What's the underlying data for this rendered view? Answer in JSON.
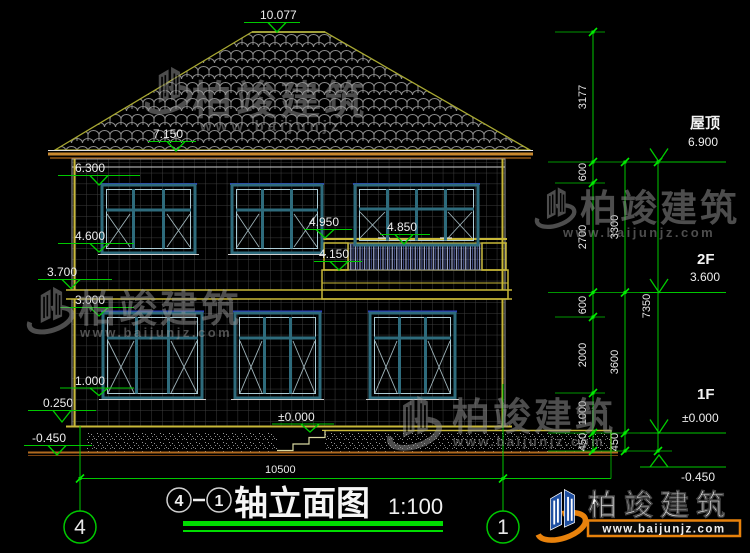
{
  "drawing": {
    "title": {
      "bubble_left": "4",
      "bubble_right": "1",
      "name": "轴立面图",
      "scale": "1:100"
    },
    "axes": {
      "left": "4",
      "right": "1"
    },
    "markers": {
      "ridge": "10.077",
      "eave": "7.150",
      "win_head_2f": "6.300",
      "sill_2f": "4.600",
      "slab_2f": "3.700",
      "win_head_1f": "3.000",
      "sill_1f": "1.000",
      "plinth": "0.250",
      "ground": "-0.450",
      "balcony_sill": "4.950",
      "rail_top": "4.850",
      "balcony_floor": "4.150",
      "zero": "±0.000"
    },
    "right_levels": [
      {
        "label": "屋顶",
        "value": "6.900"
      },
      {
        "label": "2F",
        "value": "3.600"
      },
      {
        "label": "1F",
        "value": "±0.000"
      },
      {
        "label": "",
        "value": "-0.450"
      }
    ],
    "right_dims": {
      "col_a": [
        "3177",
        "600",
        "2700",
        "600",
        "2000",
        "1000",
        "450"
      ],
      "col_b": [
        "3300",
        "3600",
        "450"
      ],
      "col_c": [
        "7350"
      ]
    },
    "bottom_dim": "10500",
    "watermark": {
      "name": "柏竣建筑",
      "url": "www.baijunjz.com",
      "url_short": "www.baijunjz"
    },
    "logo": {
      "name": "柏竣建筑",
      "url": "www.baijunjz.com"
    }
  },
  "colors": {
    "dim_green": "#00c800",
    "window_teal": "#2e6b7c",
    "band_yellow": "#c8b838",
    "eave_orange": "#c8882e",
    "logo_blue": "#1f4fa0",
    "logo_orange": "#e8820c"
  }
}
